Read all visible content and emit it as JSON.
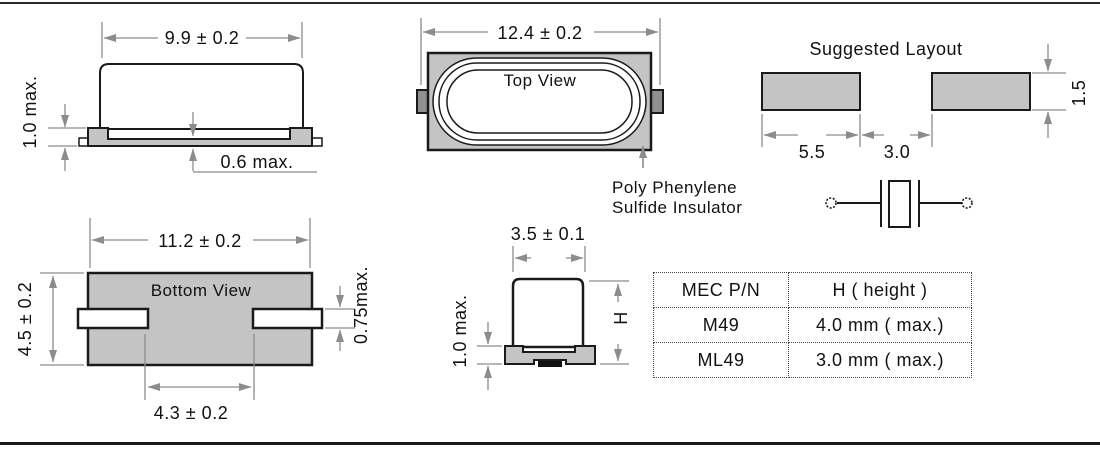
{
  "figures": {
    "side_view": {
      "width_dim": "9.9 ± 0.2",
      "base_height_dim": "1.0 max.",
      "standoff_dim": "0.6 max."
    },
    "top_view": {
      "label": "Top View",
      "width_dim": "12.4 ± 0.2"
    },
    "insulator_note": {
      "line1": "Poly Phenylene",
      "line2": "Sulfide Insulator"
    },
    "suggested_layout": {
      "title": "Suggested Layout",
      "pad_width_dim": "5.5",
      "pad_gap_dim": "3.0",
      "pad_height_dim": "1.5"
    },
    "bottom_view": {
      "label": "Bottom View",
      "width_dim": "11.2 ± 0.2",
      "height_dim": "4.5 ± 0.2",
      "lead_thickness_dim": "0.75max.",
      "lead_gap_dim": "4.3 ± 0.2"
    },
    "end_view": {
      "width_dim": "3.5 ± 0.1",
      "base_height_dim": "1.0 max.",
      "height_label": "H"
    }
  },
  "table": {
    "headers": [
      "MEC P/N",
      "H ( height )"
    ],
    "rows": [
      [
        "M49",
        "4.0 mm ( max.)"
      ],
      [
        "ML49",
        "3.0 mm ( max.)"
      ]
    ]
  },
  "colors": {
    "body_fill": "#c4c4c4",
    "lead_tab_fill": "#909090",
    "outline": "#1a1a1a",
    "dim_color": "#8c8c8c"
  }
}
